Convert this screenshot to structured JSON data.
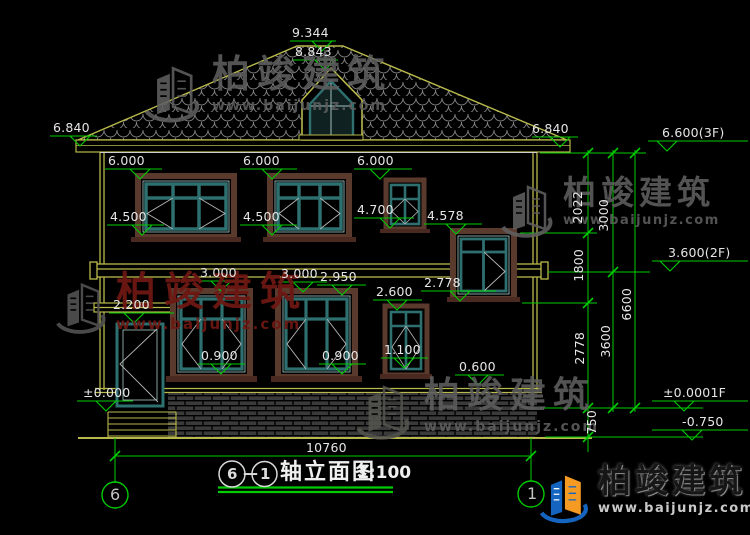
{
  "title": {
    "axis_from": "6",
    "dash": "—",
    "axis_to": "1",
    "name": "轴立面图",
    "scale": "1:100"
  },
  "axis_bubbles": {
    "left": "6",
    "right": "1"
  },
  "levels": {
    "ridge": "9.344",
    "dormer_top": "8.843",
    "eave_left": "6.840",
    "eave_right": "6.840",
    "roof_3f": "6.600(3F)",
    "floor_2f": "3.600(2F)",
    "floor_1f": "±0.0001F",
    "ground": "-0.750",
    "win2_top_a": "6.000",
    "win2_top_b": "6.000",
    "win2_top_c": "6.000",
    "win2_sill_a": "4.500",
    "win2_sill_b": "4.500",
    "win2_sill_c": "4.700",
    "stair_win_top": "4.578",
    "win1_top_a": "3.000",
    "win1_top_b": "3.000",
    "lintel": "2.950",
    "win1_top_c": "2.600",
    "stair_win_sill": "2.778",
    "canopy": "2.200",
    "win1_sill_c": "1.100",
    "win1_sill_a": "0.900",
    "win1_sill_b": "0.900",
    "plinth_top": "0.600",
    "floor_zero": "±0.000"
  },
  "dims": {
    "total_width": "10760",
    "d2022": "2022",
    "d3000": "3000",
    "d1800": "1800",
    "d2778": "2778",
    "d3600": "3600",
    "d6600": "6600",
    "d750": "750"
  },
  "watermark": {
    "brand": "柏竣建筑",
    "url": "www.baijunjz.com"
  }
}
